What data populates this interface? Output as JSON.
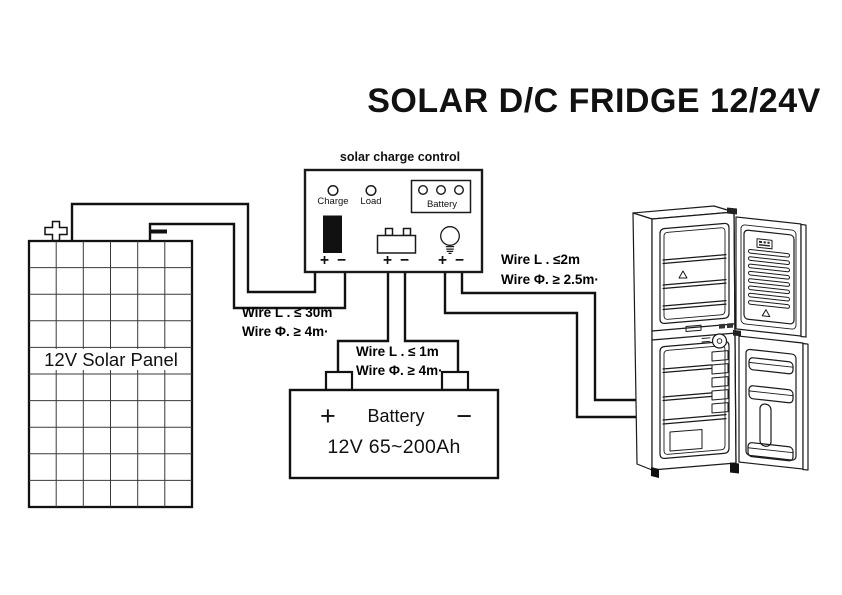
{
  "title": "SOLAR D/C FRIDGE 12/24V",
  "symbols": {
    "plus": "+",
    "minus": "−"
  },
  "controller": {
    "label": "solar charge control",
    "leds": [
      {
        "label": "Charge"
      },
      {
        "label": "Load"
      },
      {
        "label": "Battery"
      }
    ]
  },
  "solar_panel": {
    "label": "12V Solar Panel"
  },
  "battery": {
    "label": "Battery",
    "spec": "12V 65~200Ah"
  },
  "wire_specs": {
    "panel_to_controller": {
      "line1": "Wire L . ≤ 30m",
      "line2": "Wire Φ. ≥ 4m·"
    },
    "battery_to_controller": {
      "line1": "Wire L . ≤ 1m",
      "line2": "Wire Φ. ≥ 4m·"
    },
    "controller_to_fridge": {
      "line1": "Wire L . ≤2m",
      "line2": "Wire Φ. ≥ 2.5m·"
    }
  },
  "colors": {
    "line": "#1a1a1a",
    "bg": "#ffffff"
  }
}
